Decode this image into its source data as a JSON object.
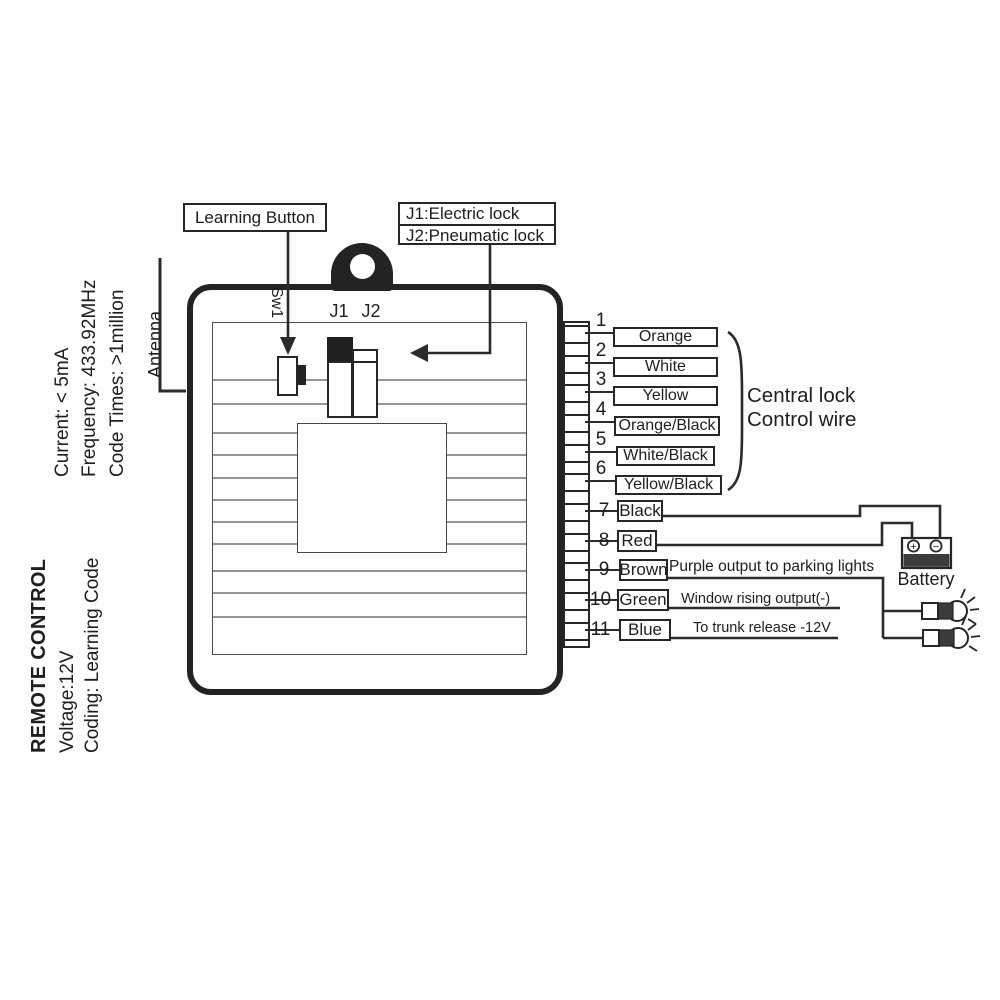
{
  "title_block": {
    "title": "REMOTE CONTROL",
    "voltage": "Voltage:12V",
    "coding": "Coding: Learning Code",
    "current": "Current: < 5mA",
    "frequency": "Frequency: 433.92MHz",
    "code_times": "Code Times: >1million"
  },
  "device": {
    "antenna_label": "Antenna",
    "switch_label": "Sw1",
    "j1_label": "J1",
    "j2_label": "J2"
  },
  "callouts": {
    "learning_button": "Learning Button",
    "jumper_info_line1": "J1:Electric lock",
    "jumper_info_line2": "J2:Pneumatic lock"
  },
  "wires": [
    {
      "num": "1",
      "color": "Orange",
      "note": ""
    },
    {
      "num": "2",
      "color": "White",
      "note": ""
    },
    {
      "num": "3",
      "color": "Yellow",
      "note": ""
    },
    {
      "num": "4",
      "color": "Orange/Black",
      "note": ""
    },
    {
      "num": "5",
      "color": "White/Black",
      "note": ""
    },
    {
      "num": "6",
      "color": "Yellow/Black",
      "note": ""
    },
    {
      "num": "7",
      "color": "Black",
      "note": ""
    },
    {
      "num": "8",
      "color": "Red",
      "note": ""
    },
    {
      "num": "9",
      "color": "Brown",
      "note": "Purple output to parking lights"
    },
    {
      "num": "10",
      "color": "Green",
      "note": "Window rising output(-)"
    },
    {
      "num": "11",
      "color": "Blue",
      "note": "To trunk release -12V"
    }
  ],
  "wire_group": {
    "line1": "Central lock",
    "line2": "Control wire"
  },
  "battery": {
    "label": "Battery",
    "positive_symbol": "+",
    "negative_symbol": "−"
  },
  "colors": {
    "line": "#2b2b2b",
    "battery_fill": "#3b3b3b",
    "jumper_fill": "#1f1f1f"
  }
}
